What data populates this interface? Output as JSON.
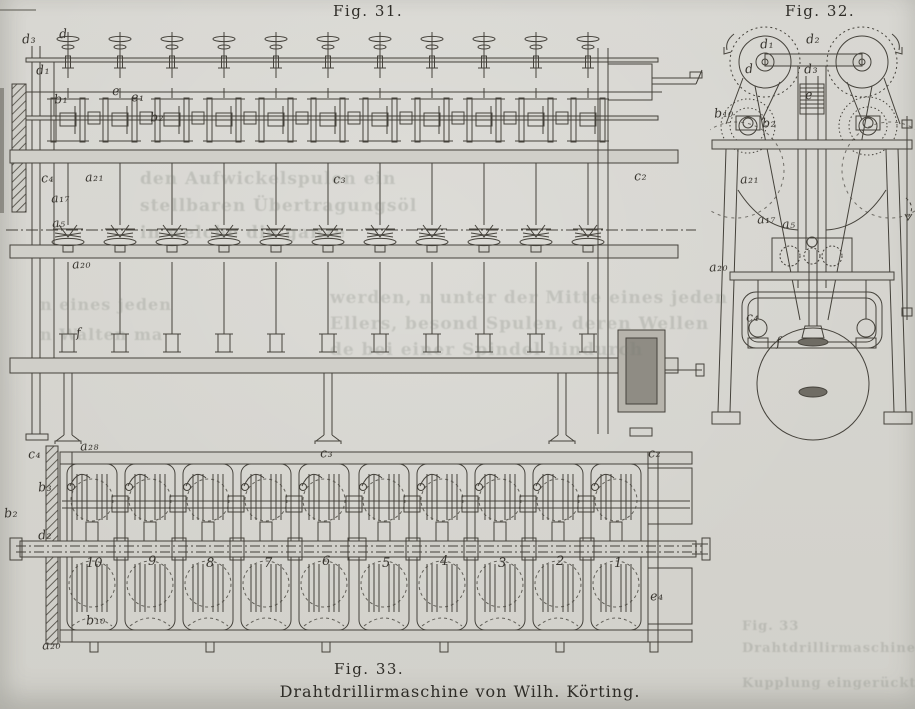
{
  "page": {
    "background": "#d7d6d1",
    "ink": "#45423b"
  },
  "figures": {
    "fig31": {
      "caption": "Fig. 31.",
      "labels": [
        {
          "t": "d₃",
          "x": 22,
          "y": 31
        },
        {
          "t": "d",
          "x": 59,
          "y": 26
        },
        {
          "t": "d₁",
          "x": 36,
          "y": 62
        },
        {
          "t": "b₁",
          "x": 54,
          "y": 91
        },
        {
          "t": "e",
          "x": 112,
          "y": 83
        },
        {
          "t": "e₁",
          "x": 131,
          "y": 89
        },
        {
          "t": "b₂",
          "x": 150,
          "y": 109
        },
        {
          "t": "c₄",
          "x": 41,
          "y": 170
        },
        {
          "t": "a₂₁",
          "x": 85,
          "y": 169
        },
        {
          "t": "c₃",
          "x": 333,
          "y": 171
        },
        {
          "t": "c₂",
          "x": 634,
          "y": 168
        },
        {
          "t": "a₁₇",
          "x": 51,
          "y": 190
        },
        {
          "t": "a₅",
          "x": 52,
          "y": 215
        },
        {
          "t": "a₂₀",
          "x": 72,
          "y": 256
        },
        {
          "t": "f",
          "x": 76,
          "y": 325
        }
      ]
    },
    "fig32": {
      "caption": "Fig. 32.",
      "labels": [
        {
          "t": "d₁",
          "x": 760,
          "y": 36
        },
        {
          "t": "d₂",
          "x": 806,
          "y": 31
        },
        {
          "t": "d",
          "x": 745,
          "y": 61
        },
        {
          "t": "d₃",
          "x": 804,
          "y": 61
        },
        {
          "t": "e",
          "x": 805,
          "y": 87
        },
        {
          "t": "b₁₀",
          "x": 714,
          "y": 105
        },
        {
          "t": "b₂",
          "x": 762,
          "y": 115
        },
        {
          "t": "a₂₁",
          "x": 740,
          "y": 171
        },
        {
          "t": "a₁₇",
          "x": 757,
          "y": 211
        },
        {
          "t": "a₅",
          "x": 782,
          "y": 216
        },
        {
          "t": "a₂₀",
          "x": 709,
          "y": 259
        },
        {
          "t": "c₄",
          "x": 746,
          "y": 309
        },
        {
          "t": "f",
          "x": 776,
          "y": 334
        }
      ]
    },
    "fig33": {
      "caption": "Fig. 33.",
      "subcaption": "Drahtdrillirmaschine von Wilh. Körting.",
      "labels": [
        {
          "t": "c₄",
          "x": 28,
          "y": 446
        },
        {
          "t": "a₂₈",
          "x": 80,
          "y": 438
        },
        {
          "t": "c₃",
          "x": 320,
          "y": 445
        },
        {
          "t": "c₂",
          "x": 648,
          "y": 445
        },
        {
          "t": "b₃",
          "x": 38,
          "y": 479
        },
        {
          "t": "b₂",
          "x": 4,
          "y": 505
        },
        {
          "t": "d₂",
          "x": 38,
          "y": 527
        },
        {
          "t": "b₁₀",
          "x": 86,
          "y": 612
        },
        {
          "t": "a₂₀",
          "x": 42,
          "y": 637
        },
        {
          "t": "e₄",
          "x": 650,
          "y": 588
        }
      ],
      "spindle_numbers": [
        {
          "n": "10",
          "x": 86,
          "y": 556
        },
        {
          "n": "9",
          "x": 148,
          "y": 554
        },
        {
          "n": "8",
          "x": 206,
          "y": 556
        },
        {
          "n": "7",
          "x": 264,
          "y": 556
        },
        {
          "n": "6",
          "x": 322,
          "y": 554
        },
        {
          "n": "5",
          "x": 382,
          "y": 556
        },
        {
          "n": "4",
          "x": 440,
          "y": 554
        },
        {
          "n": "3",
          "x": 498,
          "y": 556
        },
        {
          "n": "2",
          "x": 556,
          "y": 554
        },
        {
          "n": "1",
          "x": 614,
          "y": 556
        }
      ]
    }
  },
  "show_through": {
    "blocks": [
      {
        "x": 140,
        "y": 166,
        "size": 17,
        "lh": 27,
        "opacity": 0.26,
        "lines": [
          "den Aufwickelspulen ein",
          "stellbaren Übertragungsöl",
          "in welche die ganze"
        ]
      },
      {
        "x": 40,
        "y": 290,
        "size": 16,
        "lh": 30,
        "opacity": 0.24,
        "lines": [
          "n eines jeden",
          "n Walten ma"
        ]
      },
      {
        "x": 330,
        "y": 285,
        "size": 17,
        "lh": 26,
        "opacity": 0.24,
        "lines": [
          "werden, n unter der Mitte eines jeden",
          "Ellers, besond Spulen, deren Wellen",
          "de bei einer Spindel hindurch"
        ]
      },
      {
        "x": 742,
        "y": 616,
        "size": 13,
        "lh": 22,
        "opacity": 0.26,
        "lines": [
          "Fig. 33",
          "Drahtdrillirmaschine von Wilh.",
          "",
          "Kupplung eingerückt"
        ]
      }
    ]
  }
}
